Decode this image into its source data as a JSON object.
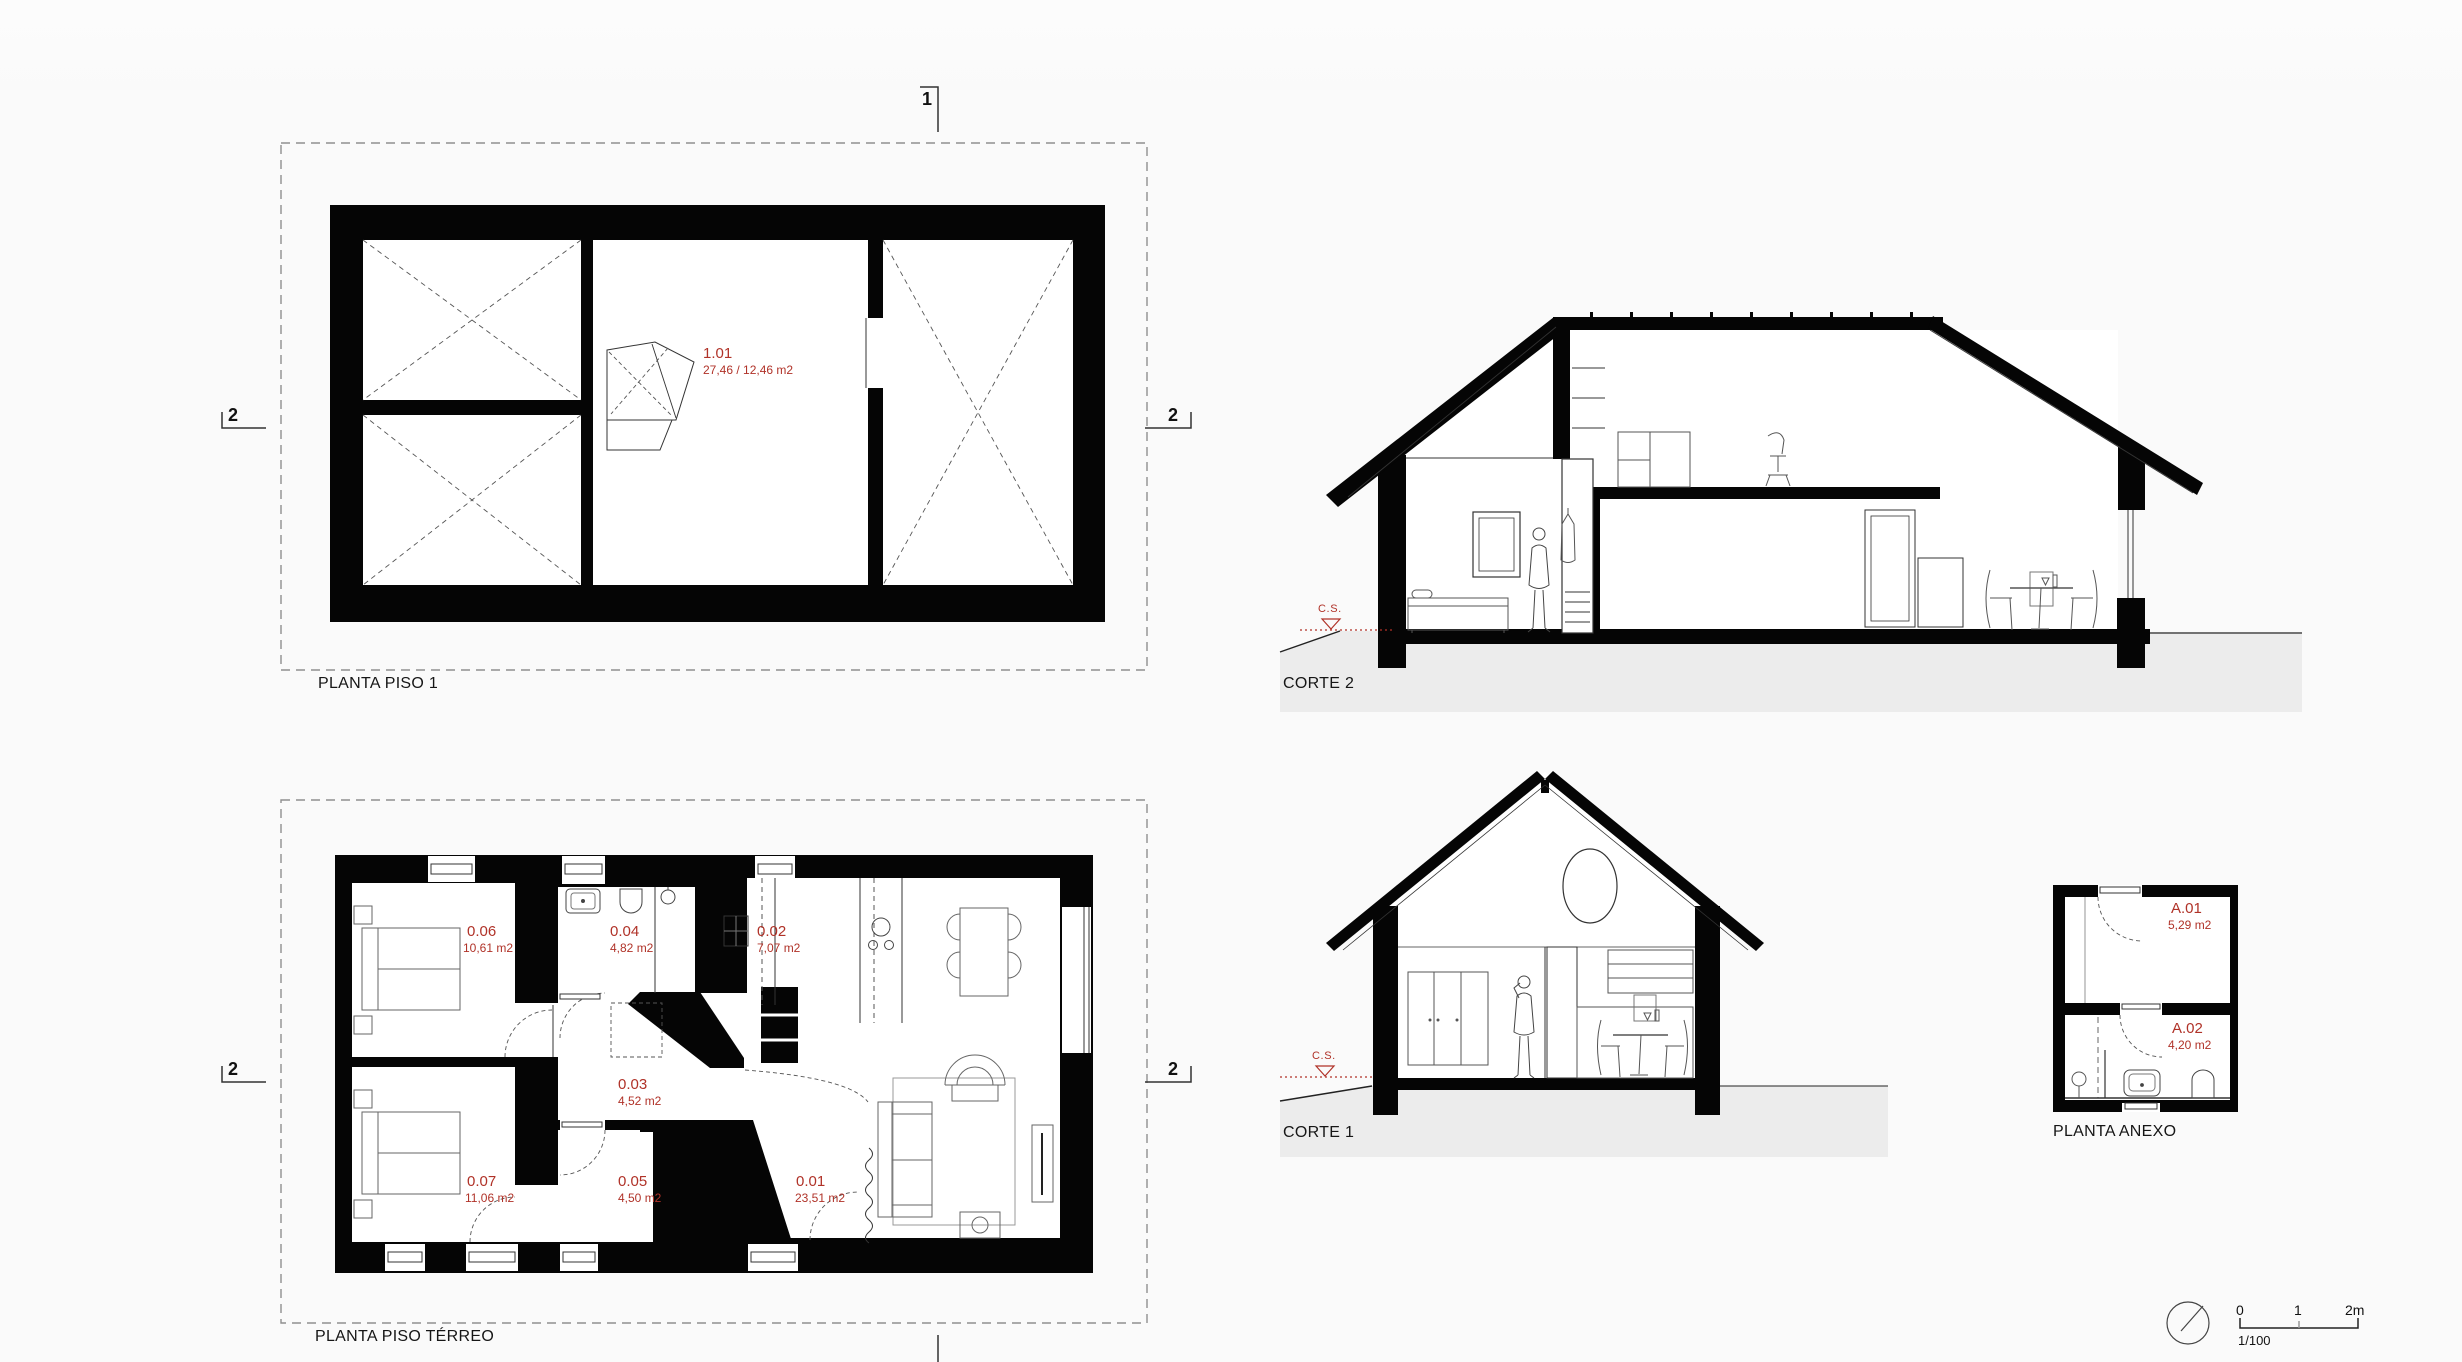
{
  "colors": {
    "red": "#b03228",
    "ground": "#ececec",
    "background": "#fafafa",
    "wall": "#050505"
  },
  "titles": {
    "piso1": "PLANTA PISO 1",
    "terreo": "PLANTA PISO TÉRREO",
    "anexo": "PLANTA ANEXO",
    "corte1": "CORTE 1",
    "corte2": "CORTE 2"
  },
  "markers": {
    "cut1": "1",
    "cut2": "2",
    "level": "C.S."
  },
  "rooms": {
    "r101": {
      "id": "1.01",
      "area": "27,46 / 12,46 m2"
    },
    "r001": {
      "id": "0.01",
      "area": "23,51 m2"
    },
    "r002": {
      "id": "0.02",
      "area": "7,07 m2"
    },
    "r003": {
      "id": "0.03",
      "area": "4,52 m2"
    },
    "r004": {
      "id": "0.04",
      "area": "4,82 m2"
    },
    "r005": {
      "id": "0.05",
      "area": "4,50 m2"
    },
    "r006": {
      "id": "0.06",
      "area": "10,61 m2"
    },
    "r007": {
      "id": "0.07",
      "area": "11,06 m2"
    },
    "a01": {
      "id": "A.01",
      "area": "5,29 m2"
    },
    "a02": {
      "id": "A.02",
      "area": "4,20 m2"
    }
  },
  "scale_bar": {
    "tick_0": "0",
    "tick_1": "1",
    "tick_2": "2m",
    "ratio": "1/100"
  }
}
